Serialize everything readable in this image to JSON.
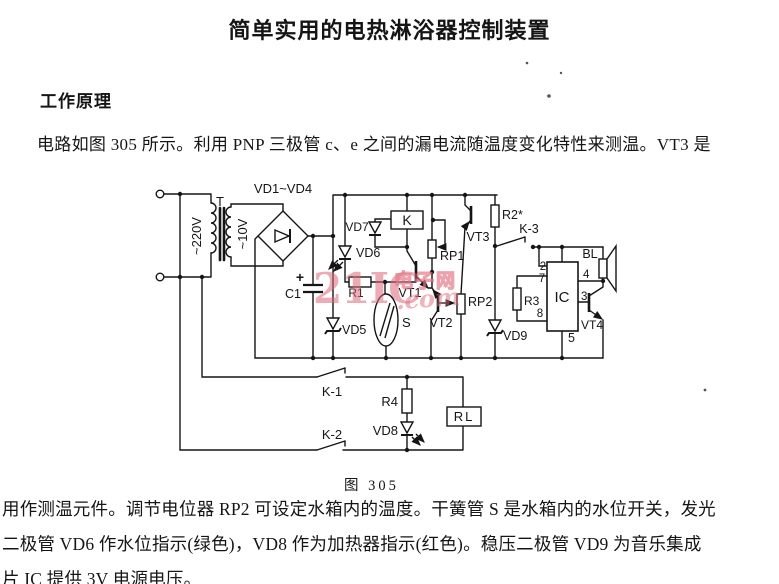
{
  "page": {
    "title": "简单实用的电热淋浴器控制装置",
    "section_heading": "工作原理",
    "intro_paragraph": "电路如图 305 所示。利用 PNP 三极管 c、e 之间的漏电流随温度变化特性来测温。VT3 是",
    "body_lines": [
      "用作测温元件。调节电位器 RP2 可设定水箱内的温度。干簧管 S 是水箱内的水位开关，发光",
      "二极管 VD6 作水位指示(绿色)，VD8 作为加热器指示(红色)。稳压二极管 VD9 为音乐集成",
      "片 IC 提供 3V 电源电压。"
    ]
  },
  "figure": {
    "caption": "图 305",
    "watermark": {
      "main": "21IC",
      "cn": "电子网",
      "suffix": ".com"
    },
    "labels": {
      "t": "T",
      "v220": "~220V",
      "v10": "~10V",
      "bridge": "VD1~VD4",
      "c1": "C1",
      "plus": "+",
      "vd5": "VD5",
      "vd6": "VD6",
      "vd7": "VD7",
      "k": "K",
      "r1": "R1",
      "s": "S",
      "vt1": "VT1",
      "rp1": "RP1",
      "vt2": "VT2",
      "rp2": "RP2",
      "vt3": "VT3",
      "r2": "R2*",
      "k3": "K-3",
      "vd9": "VD9",
      "r3": "R3",
      "ic": "IC",
      "bl": "BL",
      "vt4": "VT4",
      "pin2": "2",
      "pin7": "7",
      "pin8": "8",
      "pin4": "4",
      "pin3": "3",
      "pin5": "5",
      "k1": "K-1",
      "k2": "K-2",
      "r4": "R4",
      "vd8": "VD8",
      "rl": "RL"
    }
  }
}
